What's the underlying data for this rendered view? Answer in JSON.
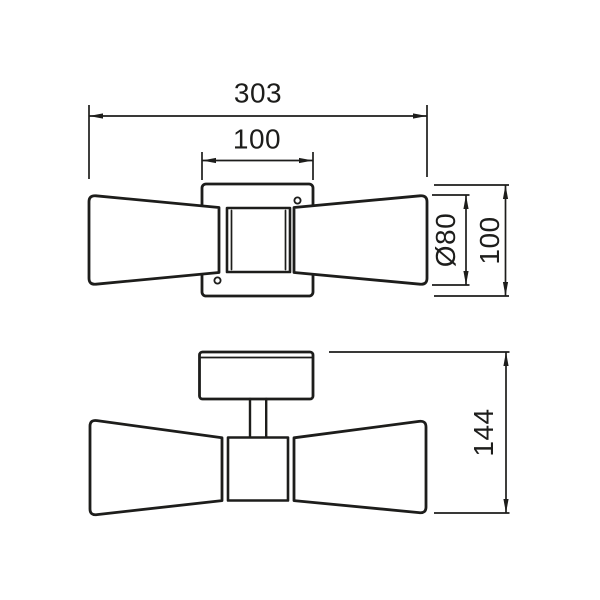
{
  "drawing": {
    "subject": "double-cone wall light fixture",
    "views": {
      "front_view": "bow-tie shades with square backplate",
      "side_view": "backplate with stem and bow-tie profile"
    }
  },
  "colors": {
    "line": "#1d1d1b",
    "background": "#ffffff"
  },
  "dimensions": {
    "overall_width": "303",
    "backplate_width": "100",
    "shade_diameter": "Ø80",
    "backplate_height": "100",
    "overall_depth": "144"
  }
}
